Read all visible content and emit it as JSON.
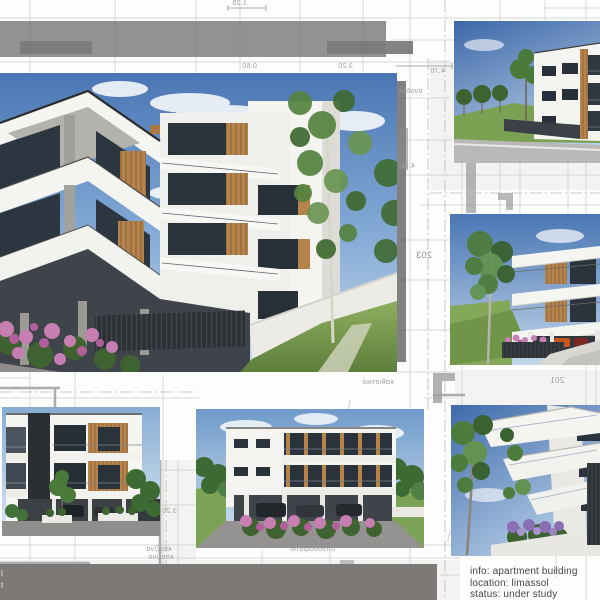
{
  "info_panel": {
    "line1": "info: apartment building",
    "line2": "location: limassol",
    "line3": "status: under study"
  },
  "footer_bar": {
    "fragment_line1": "l",
    "fragment_line2": "t"
  },
  "plan_annotations": {
    "dim_125": "1.25",
    "dim_060a": "0.60",
    "dim_320a": "3.20",
    "dim_470": "4.70",
    "dim_480": "4.80",
    "dim_320b": "3.20",
    "room_203": "203",
    "room_201": "201",
    "label_stairs": "ανοδος",
    "label_living": "καθιστικό",
    "label_bedroom": "υπνοδωμάτιο",
    "label_kitchen_a": "κουζίνα",
    "label_kitchen_b": "κουζίνα"
  },
  "colors": {
    "bar_gray": "#7d7977",
    "top_bar_gray": "#7a7a7a",
    "sky_blue": "#4a76b4",
    "sky_light": "#c9dcec",
    "building_white": "#f4f4f0",
    "glazing_dark": "#2a323c",
    "wood_accent": "#b5834c",
    "foliage_green": "#4e7c3c",
    "lawn_green": "#7ea353",
    "flower_pink": "#c77fb3",
    "lavender_purple": "#8a6fb4",
    "fence_dark": "#2d3237",
    "plan_line": "#d6d6d6",
    "info_text": "#454545"
  }
}
